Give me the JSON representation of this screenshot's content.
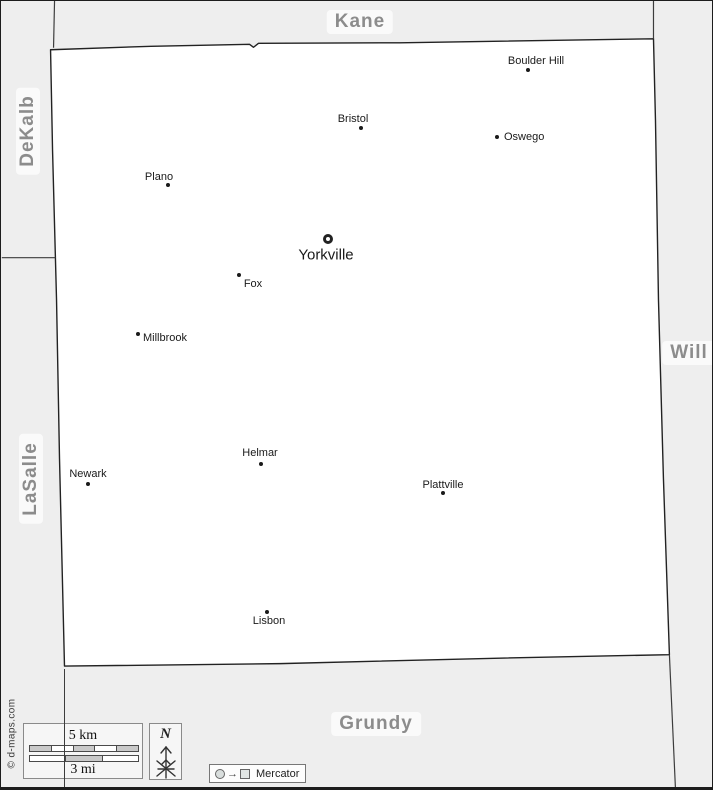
{
  "colors": {
    "background": "#eeeeee",
    "county_fill": "#ffffff",
    "border_line": "#2f2f2f",
    "county_label_text": "#8c8c8c",
    "county_label_bg": "#fafafa",
    "place_text": "#1a1a1a"
  },
  "counties": [
    {
      "name": "Kane",
      "x": 359,
      "y": 21,
      "rotated": false
    },
    {
      "name": "DeKalb",
      "x": 27,
      "y": 130,
      "rotated": true
    },
    {
      "name": "LaSalle",
      "x": 30,
      "y": 478,
      "rotated": true
    },
    {
      "name": "Will",
      "x": 688,
      "y": 352,
      "rotated": false
    },
    {
      "name": "Grundy",
      "x": 375,
      "y": 723,
      "rotated": false
    }
  ],
  "places": [
    {
      "name": "Boulder Hill",
      "marker": "dot",
      "mx": 527,
      "my": 69,
      "lx": 535,
      "ly": 60,
      "anchor": "center",
      "size": 11
    },
    {
      "name": "Bristol",
      "marker": "dot",
      "mx": 360,
      "my": 127,
      "lx": 352,
      "ly": 118,
      "anchor": "center",
      "size": 11
    },
    {
      "name": "Oswego",
      "marker": "dot",
      "mx": 496,
      "my": 136,
      "lx": 503,
      "ly": 136,
      "anchor": "left",
      "size": 11
    },
    {
      "name": "Plano",
      "marker": "dot",
      "mx": 167,
      "my": 184,
      "lx": 158,
      "ly": 176,
      "anchor": "center",
      "size": 11
    },
    {
      "name": "Yorkville",
      "marker": "ring",
      "mx": 327,
      "my": 238,
      "lx": 325,
      "ly": 254,
      "anchor": "center",
      "size": 15
    },
    {
      "name": "Fox",
      "marker": "dot",
      "mx": 238,
      "my": 274,
      "lx": 252,
      "ly": 283,
      "anchor": "center",
      "size": 11
    },
    {
      "name": "Millbrook",
      "marker": "dot",
      "mx": 137,
      "my": 333,
      "lx": 142,
      "ly": 337,
      "anchor": "left",
      "size": 11
    },
    {
      "name": "Newark",
      "marker": "dot",
      "mx": 87,
      "my": 483,
      "lx": 87,
      "ly": 473,
      "anchor": "center",
      "size": 11
    },
    {
      "name": "Helmar",
      "marker": "dot",
      "mx": 260,
      "my": 463,
      "lx": 259,
      "ly": 452,
      "anchor": "center",
      "size": 11
    },
    {
      "name": "Plattville",
      "marker": "dot",
      "mx": 442,
      "my": 492,
      "lx": 442,
      "ly": 484,
      "anchor": "center",
      "size": 11
    },
    {
      "name": "Lisbon",
      "marker": "dot",
      "mx": 266,
      "my": 611,
      "lx": 268,
      "ly": 620,
      "anchor": "center",
      "size": 11
    }
  ],
  "scale": {
    "km_label": "5 km",
    "mi_label": "3 mi"
  },
  "north": {
    "label": "N"
  },
  "legend": {
    "arrow_glyph": "→",
    "projection": "Mercator"
  },
  "copyright": "© d-maps.com"
}
